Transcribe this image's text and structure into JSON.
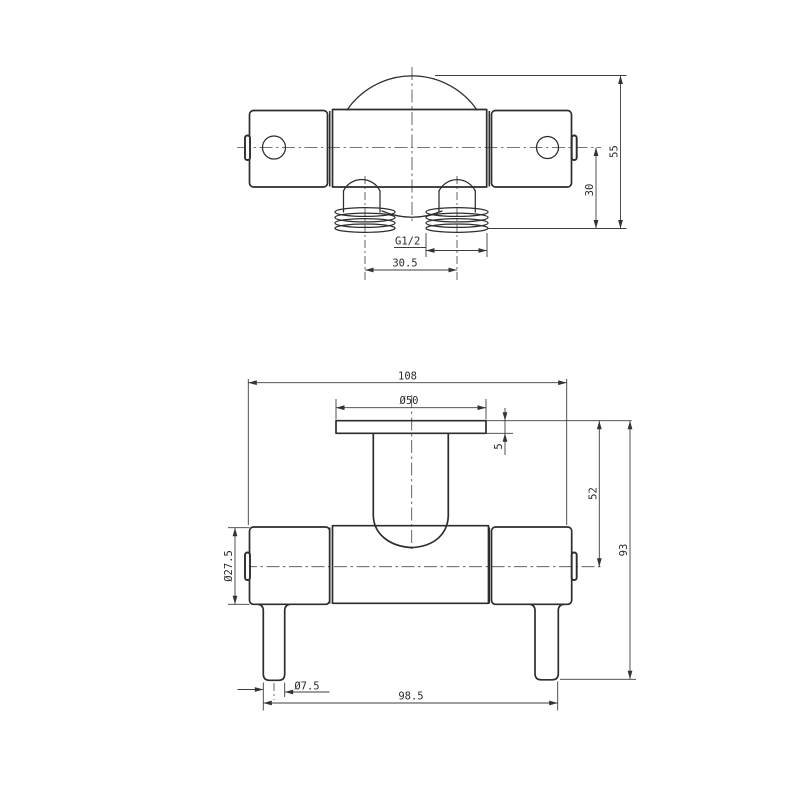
{
  "page": {
    "background": "#ffffff",
    "line_color": "#2d2d2d",
    "dim_color": "#3d3d3d"
  },
  "views": {
    "top": {
      "label": "top-view",
      "dims": {
        "thread": "G1/2",
        "port_spacing": "30.5",
        "center_height": "30",
        "overall_height": "55"
      }
    },
    "front": {
      "label": "front-view",
      "dims": {
        "overall_width": "108",
        "knob_diameter": "Ø50",
        "flange_thickness": "5",
        "upper_height": "52",
        "overall_height": "93",
        "body_diameter": "Ø27.5",
        "lever_tip_diameter": "Ø7.5",
        "lever_span": "98.5"
      }
    }
  }
}
